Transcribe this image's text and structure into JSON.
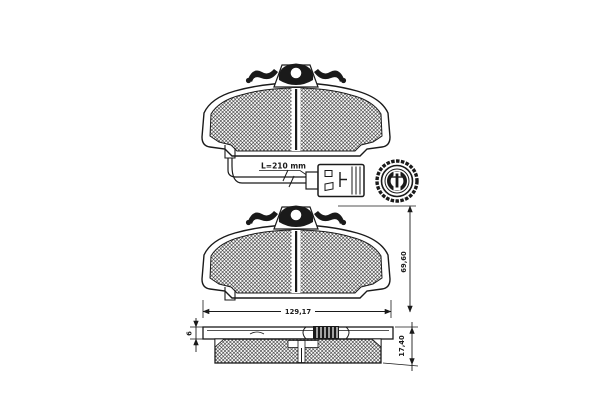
{
  "window": {
    "background": "#ffffff",
    "ink": "#1a1a1a"
  },
  "diagram": {
    "kind": "technical-parts-drawing",
    "subject": "disc brake pad set with acoustic wear sensor lead",
    "views": {
      "top": {
        "name": "brake pad front view with wear sensor lead and connectors"
      },
      "middle": {
        "name": "brake pad front view with overall dimensions"
      },
      "bottom": {
        "name": "brake pad side profile with thickness dimensions"
      }
    },
    "labels": {
      "sensor_length": "L=210 mm",
      "pad_width": "129,17",
      "pad_height": "69,60",
      "pad_thickness": "17,40",
      "backplate_thickness": "6"
    },
    "dimensions": [
      {
        "name": "wear sensor lead length",
        "value": "L=210 mm"
      },
      {
        "name": "pad width",
        "value": "129,17",
        "unit": "mm"
      },
      {
        "name": "pad height",
        "value": "69,60",
        "unit": "mm"
      },
      {
        "name": "pad total thickness",
        "value": "17,40",
        "unit": "mm"
      },
      {
        "name": "backplate thickness",
        "value": "6",
        "unit": "mm"
      }
    ]
  }
}
